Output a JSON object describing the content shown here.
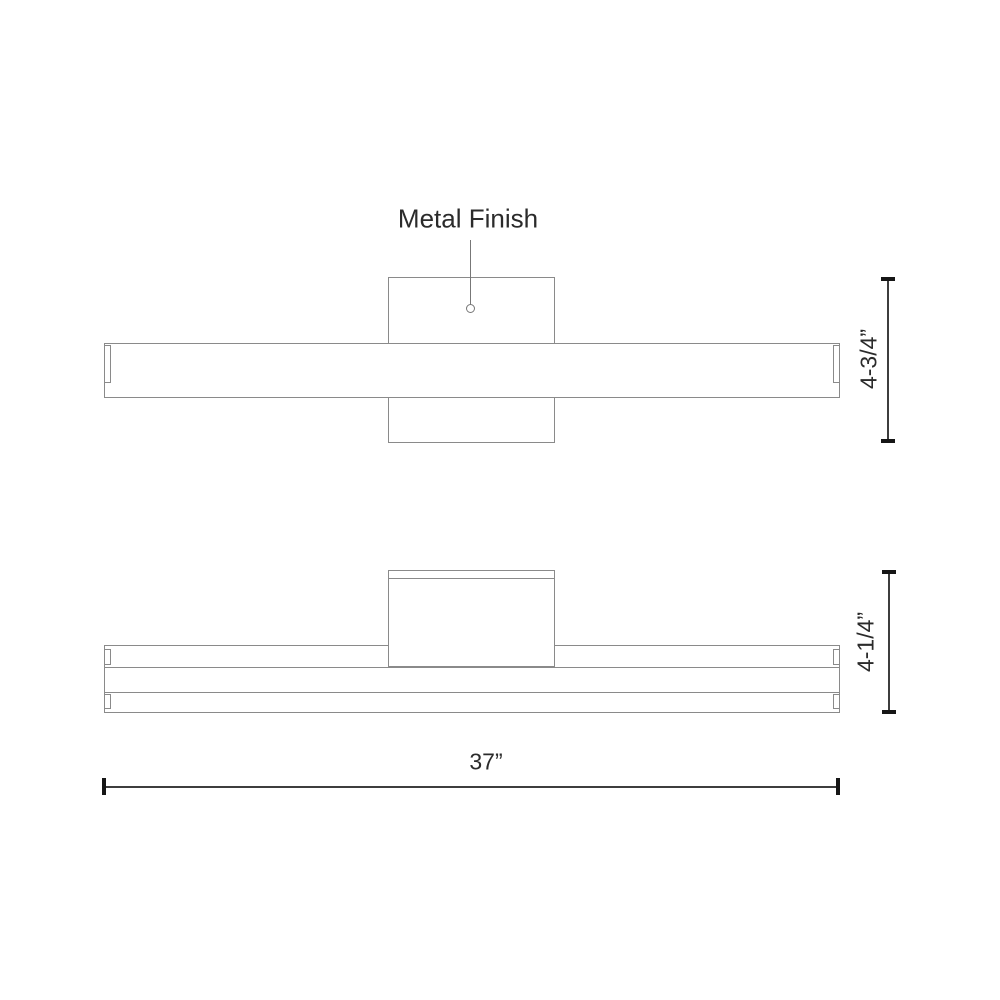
{
  "labels": {
    "metal_finish": "Metal Finish"
  },
  "dimensions": {
    "front_height": "4-3/4”",
    "plan_depth": "4-1/4”",
    "overall_width": "37”"
  },
  "colors": {
    "background": "#ffffff",
    "drawing_line": "#8a8a8a",
    "dimension_line": "#3d3d3d",
    "dimension_tick": "#161616",
    "text": "#2b2b2b"
  }
}
